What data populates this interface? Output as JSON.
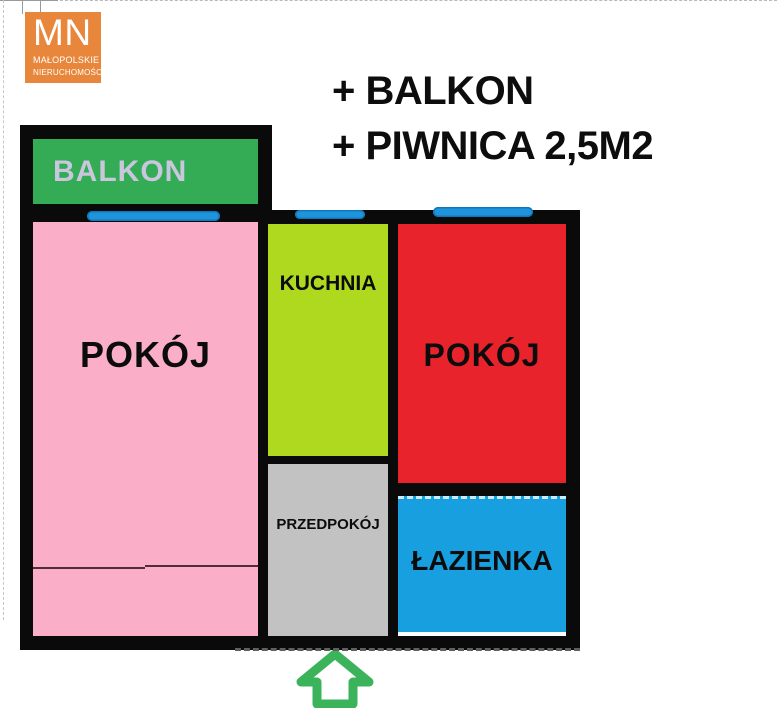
{
  "logo": {
    "initials": "MN",
    "line1": "MAŁOPOLSKIE",
    "line2": "NIERUCHOMOŚCI",
    "bg_color": "#e8873b",
    "text_color": "#ffffff"
  },
  "header": {
    "line1": "+ BALKON",
    "line2": "+ PIWNICA 2,5M2"
  },
  "floorplan": {
    "rooms": [
      {
        "id": "balkon",
        "label": "BALKON",
        "fill": "#33ac55",
        "label_color": "#c9c6dd"
      },
      {
        "id": "pokoj-left",
        "label": "POKÓJ",
        "fill": "#fbaec8",
        "label_color": "#0c0c0c"
      },
      {
        "id": "kuchnia",
        "label": "KUCHNIA",
        "fill": "#afd91e",
        "label_color": "#0c0c0c"
      },
      {
        "id": "pokoj-right",
        "label": "POKÓJ",
        "fill": "#e9232b",
        "label_color": "#0c0c0c"
      },
      {
        "id": "przedpokoj",
        "label": "PRZEDPOKÓJ",
        "fill": "#c2c2c2",
        "label_color": "#0c0c0c"
      },
      {
        "id": "lazienka",
        "label": "ŁAZIENKA",
        "fill": "#179fe0",
        "label_color": "#0c0c0c"
      }
    ],
    "colors": {
      "wall": "#0a0a0a",
      "window_marker": "#1d94db",
      "entrance_arrow": "#3bb35a"
    },
    "entrance_icon": "up-arrow"
  }
}
